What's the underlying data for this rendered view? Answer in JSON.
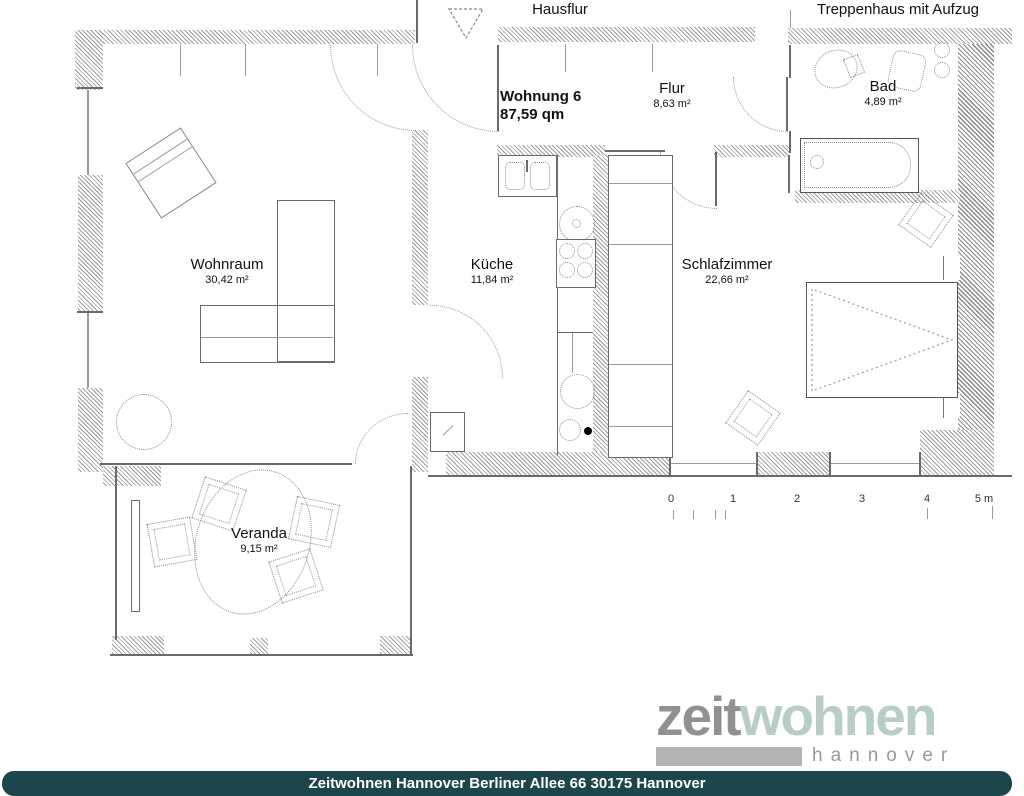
{
  "building": {
    "hausflur_label": "Hausflur",
    "treppenhaus_label": "Treppenhaus mit Aufzug"
  },
  "apartment": {
    "name": "Wohnung 6",
    "area": "87,59 qm"
  },
  "rooms": {
    "wohnraum": {
      "name": "Wohnraum",
      "area": "30,42 m²"
    },
    "kueche": {
      "name": "Küche",
      "area": "11,84 m²"
    },
    "flur": {
      "name": "Flur",
      "area": "8,63 m²"
    },
    "bad": {
      "name": "Bad",
      "area": "4,89 m²"
    },
    "schlafzimmer": {
      "name": "Schlafzimmer",
      "area": "22,66 m²"
    },
    "veranda": {
      "name": "Veranda",
      "area": "9,15 m²"
    }
  },
  "scale_bar": {
    "labels": [
      "0",
      "1",
      "2",
      "3",
      "4",
      "5 m"
    ]
  },
  "branding": {
    "logo_text_primary": "zeit",
    "logo_text_secondary": "wohnen",
    "logo_subtitle": "hannover",
    "logo_color_primary": "#8f9193",
    "logo_color_secondary": "#b7cec6",
    "footer_text": "Zeitwohnen Hannover Berliner Allee 66 30175 Hannover",
    "footer_bg_color": "#1c464b",
    "footer_text_color": "#ffffff"
  }
}
